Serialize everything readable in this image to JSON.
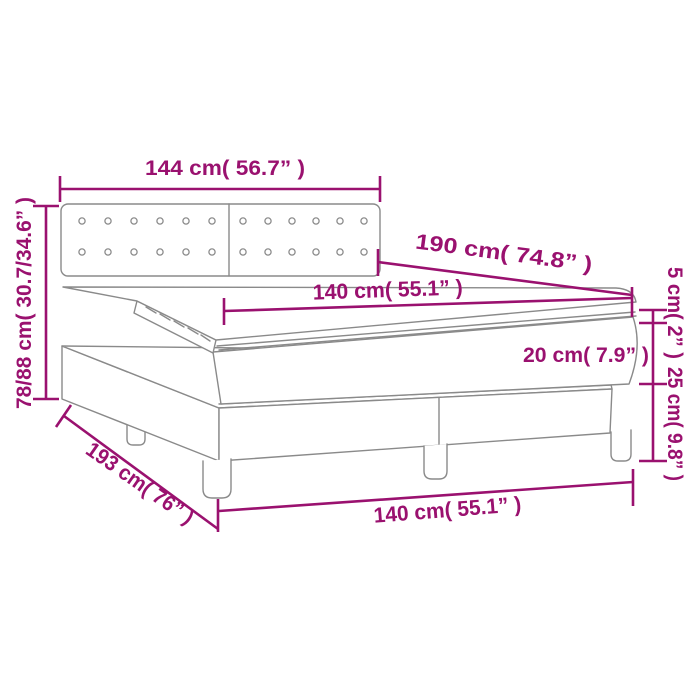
{
  "diagram": {
    "title": "box-spring-bed-dimension-diagram",
    "colors": {
      "dimension_accent": "#9A116F",
      "drawing_gray": "#8A8A8A",
      "background": "#FFFFFF"
    },
    "labels": {
      "headboard_width": "144 cm( 56.7” )",
      "total_height": "78/88 cm( 30.7/34.6” )",
      "mattress_length": "190 cm( 74.8” )",
      "mattress_width_top": "140 cm( 55.1” )",
      "topper_thickness": "5 cm( 2” )",
      "mattress_thickness": "20 cm( 7.9” )",
      "base_height": "25 cm( 9.8” )",
      "bed_total_length": "193 cm( 76” )",
      "bed_width_bottom": "140 cm( 55.1” )"
    }
  }
}
